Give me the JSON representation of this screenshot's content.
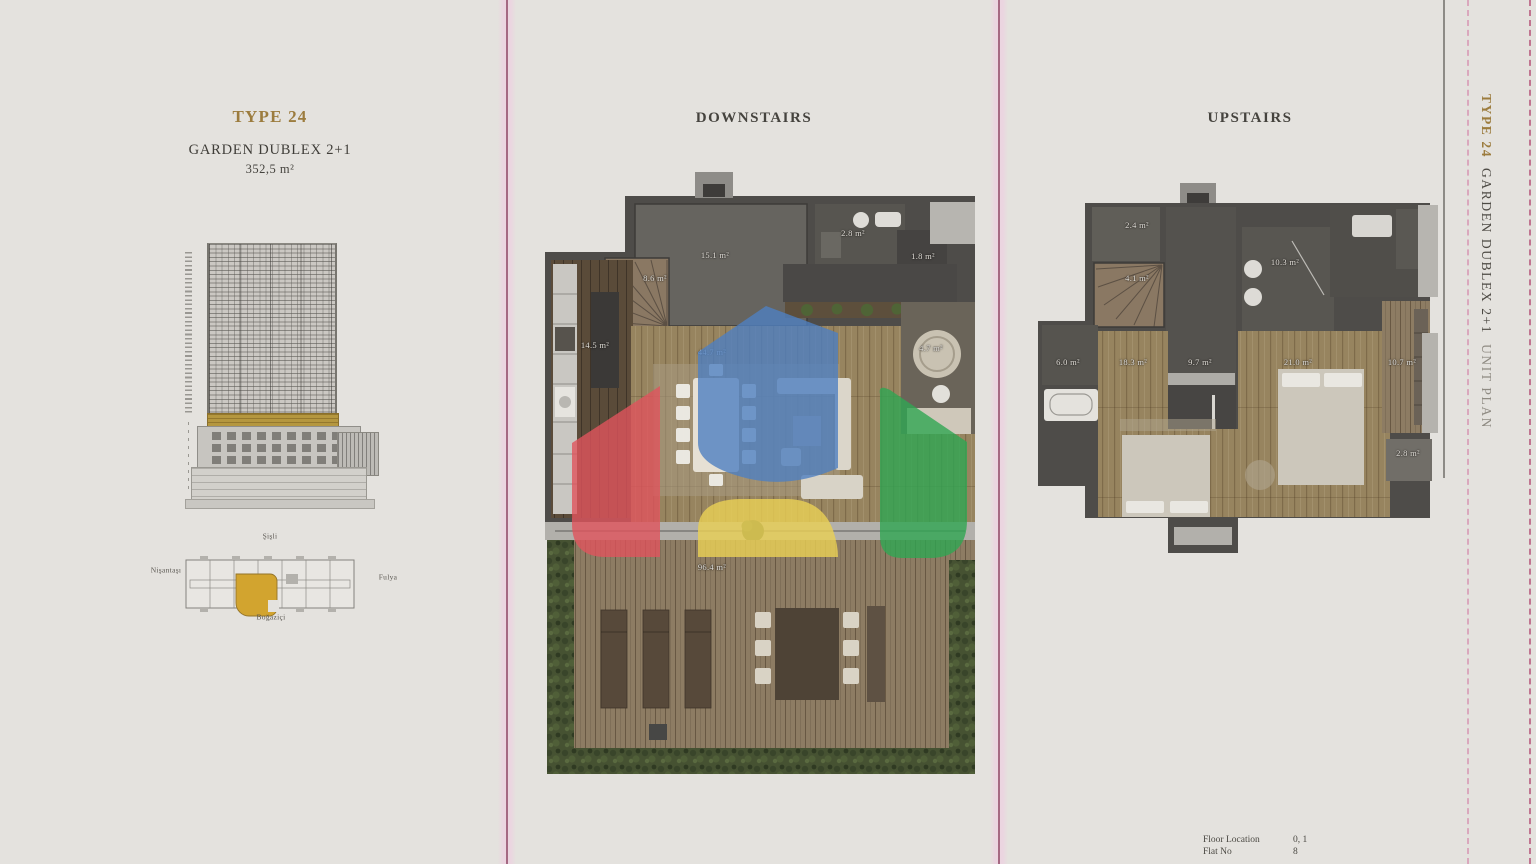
{
  "page": {
    "bg": "#e4e2de"
  },
  "left_panel": {
    "type_title": "TYPE 24",
    "unit_name": "GARDEN DUBLEX 2+1",
    "total_area": "352,5 m²",
    "site_labels": {
      "top": "Şişli",
      "left": "Nişantaşı",
      "right": "Fulya",
      "bottom": "Boğaziçi"
    }
  },
  "downstairs": {
    "title": "DOWNSTAIRS",
    "rooms": [
      {
        "label": "15.1 m²",
        "x": 170,
        "y": 83
      },
      {
        "label": "2.8 m²",
        "x": 308,
        "y": 61
      },
      {
        "label": "1.8 m²",
        "x": 378,
        "y": 84
      },
      {
        "label": "8.6 m²",
        "x": 110,
        "y": 106
      },
      {
        "label": "14.5 m²",
        "x": 50,
        "y": 173
      },
      {
        "label": "44.7 m²",
        "x": 167,
        "y": 180
      },
      {
        "label": "4.7 m²",
        "x": 386,
        "y": 176
      },
      {
        "label": "96.4 m²",
        "x": 167,
        "y": 395
      }
    ]
  },
  "upstairs": {
    "title": "UPSTAIRS",
    "rooms": [
      {
        "label": "2.4 m²",
        "x": 107,
        "y": 42
      },
      {
        "label": "4.1 m²",
        "x": 107,
        "y": 95
      },
      {
        "label": "10.3 m²",
        "x": 255,
        "y": 79
      },
      {
        "label": "9.7 m²",
        "x": 170,
        "y": 179
      },
      {
        "label": "6.0 m²",
        "x": 38,
        "y": 179
      },
      {
        "label": "18.3 m²",
        "x": 103,
        "y": 179
      },
      {
        "label": "21.0 m²",
        "x": 268,
        "y": 179
      },
      {
        "label": "10.7 m²",
        "x": 372,
        "y": 179
      },
      {
        "label": "2.8 m²",
        "x": 378,
        "y": 270
      }
    ]
  },
  "side_strip": {
    "type_title": "TYPE 24",
    "unit_name": "GARDEN DUBLEX 2+1",
    "suffix": "UNIT PLAN"
  },
  "footer": {
    "rows": [
      {
        "label": "Floor Location",
        "value": "0, 1"
      },
      {
        "label": "Flat No",
        "value": "8"
      }
    ]
  },
  "colors": {
    "accent_gold": "#9c7c3e",
    "divider_pink": "#944d6b",
    "watermark": {
      "blue": "#4f7fc0",
      "red": "#e0545c",
      "yellow": "#e9cf55",
      "green": "#2fa653"
    }
  }
}
